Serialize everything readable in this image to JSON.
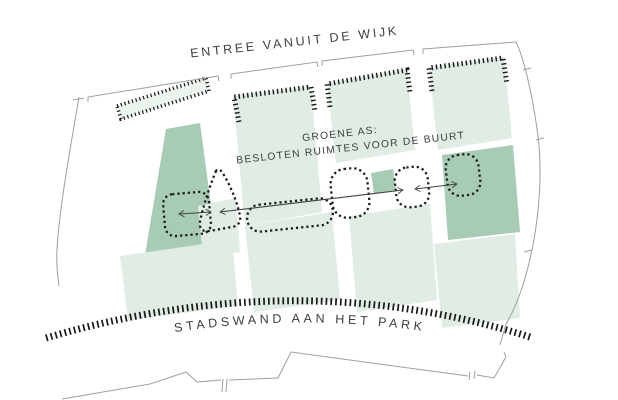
{
  "diagram": {
    "labels": {
      "top": "ENTREE VANUIT DE WIJK",
      "axis_line1": "GROENE AS:",
      "axis_line2": "BESLOTEN RUIMTES VOOR DE BUURT",
      "bottom": "STADSWAND AAN HET PARK"
    },
    "colors": {
      "block_light": "#e0ece4",
      "block_pale": "#ecf4ee",
      "block_dark": "#a8cbb5",
      "hatch": "#181818",
      "boundary": "#98a29e",
      "axis_line": "#3f4443",
      "label": "#3a3f3d",
      "background": "#ffffff"
    }
  }
}
